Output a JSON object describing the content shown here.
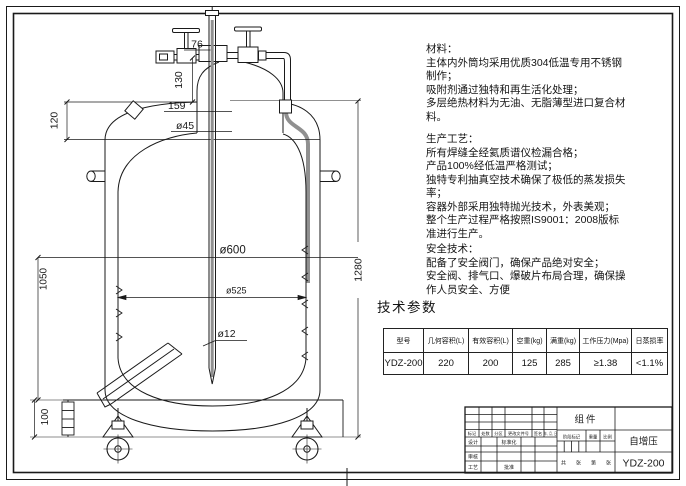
{
  "colors": {
    "line": "#1a1a1a",
    "aux_gray": "#909090"
  },
  "drawing": {
    "dims": {
      "d76": "76",
      "d130": "130",
      "d120": "120",
      "d159": "159",
      "d45": "ø45",
      "d600": "ø600",
      "d525": "ø525",
      "d12": "ø12",
      "d1050": "1050",
      "d100": "100",
      "d1280": "1280"
    }
  },
  "notes": {
    "materials": {
      "title": "材料：",
      "lines": [
        "主体内外筒均采用优质304低温专用不锈钢",
        "制作；",
        "吸附剂通过独特和再生活化处理；",
        "多层绝热材料为无油、无脂薄型进口复合材",
        "料。"
      ]
    },
    "process": {
      "title": "生产工艺：",
      "lines": [
        "所有焊缝全经氦质谱仪检漏合格；",
        "产品100%经低温严格测试；",
        "独特专利抽真空技术确保了极低的蒸发损失",
        "率；",
        "容器外部采用独特抛光技术，外表美观；",
        "整个生产过程严格按照IS9001：2008版标",
        "准进行生产。"
      ]
    },
    "safety": {
      "title": "安全技术：",
      "lines": [
        "配备了安全阀门，确保产品绝对安全；",
        "安全阀、排气口、爆破片布局合理，确保操",
        "作人员安全、方便"
      ]
    }
  },
  "params": {
    "heading": "技术参数",
    "table": {
      "headers": [
        "型号",
        "几何容积(L)",
        "有效容积(L)",
        "空重(kg)",
        "满重(kg)",
        "工作压力(Mpa)",
        "日蒸损率"
      ],
      "rows": [
        [
          "YDZ-200",
          "220",
          "200",
          "125",
          "285",
          "≥1.38",
          "<1.1%"
        ]
      ]
    }
  },
  "titleblock": {
    "component": "组件",
    "product": "自增压",
    "model": "YDZ-200",
    "rev_row": [
      "标记",
      "处数",
      "分区",
      "更改文件号",
      "签名",
      "年、月、日"
    ],
    "roles": [
      "设计",
      "审核",
      "工艺"
    ],
    "roles_mid": [
      "标准化",
      "批准"
    ],
    "stage_row": [
      "阶段标记",
      "重量",
      "比例"
    ],
    "sheet_row": [
      "共",
      "张",
      "第",
      "张"
    ]
  }
}
